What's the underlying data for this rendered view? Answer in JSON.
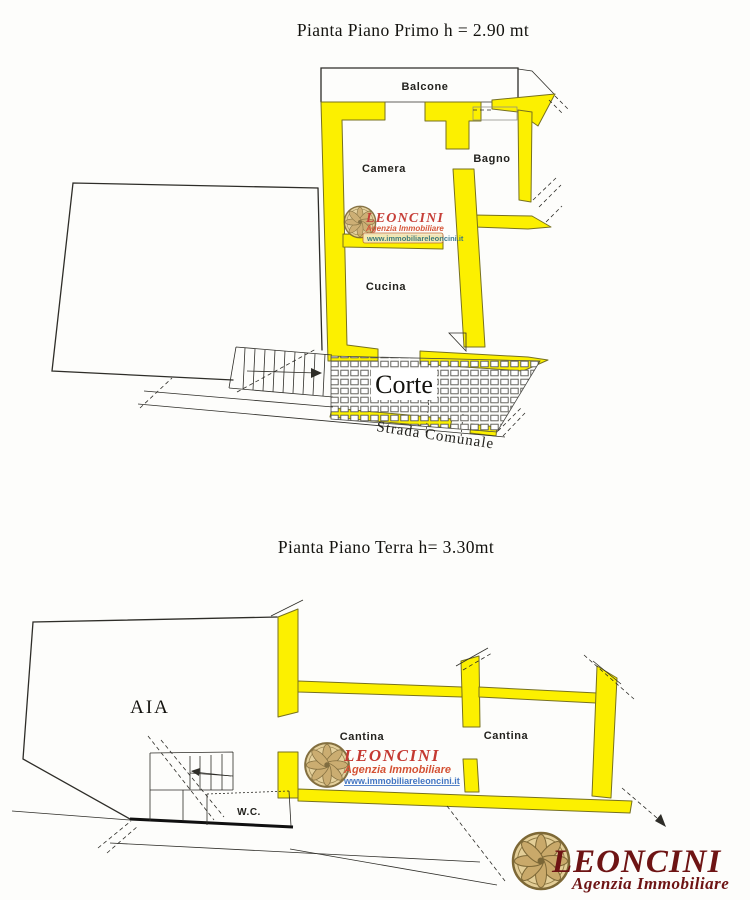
{
  "plans": {
    "first_floor": {
      "title": "Pianta Piano Primo h = 2.90 mt",
      "rooms": {
        "balcone": "Balcone",
        "camera": "Camera",
        "bagno": "Bagno",
        "cucina": "Cucina",
        "corte": "Corte",
        "strada": "Strada Comunale"
      }
    },
    "ground_floor": {
      "title": "Pianta Piano Terra h=  3.30mt",
      "rooms": {
        "aia": "AIA",
        "cantina1": "Cantina",
        "cantina2": "Cantina",
        "wc": "W.C."
      }
    }
  },
  "watermark": {
    "name": "LEONCINI",
    "tagline": "Agenzia Immobiliare",
    "website": "www.immobiliareleoncini.it"
  },
  "logo": {
    "name": "LEONCINI",
    "tagline": "Agenzia Immobiliare"
  },
  "colors": {
    "wall_yellow": "#FCF000",
    "wall_edge": "#77711F",
    "ink": "#2E2D28",
    "hatch_ink": "#4A4A46",
    "brand_red": "#C22F28",
    "brand_red2": "#D2492A",
    "website_teal": "#2E7187",
    "website_blue": "#3A6FC0",
    "logo_maroon": "#6E1414",
    "rosette_light": "#E3CE97",
    "rosette_mid": "#C9A96A",
    "rosette_dark": "#7D6836"
  }
}
